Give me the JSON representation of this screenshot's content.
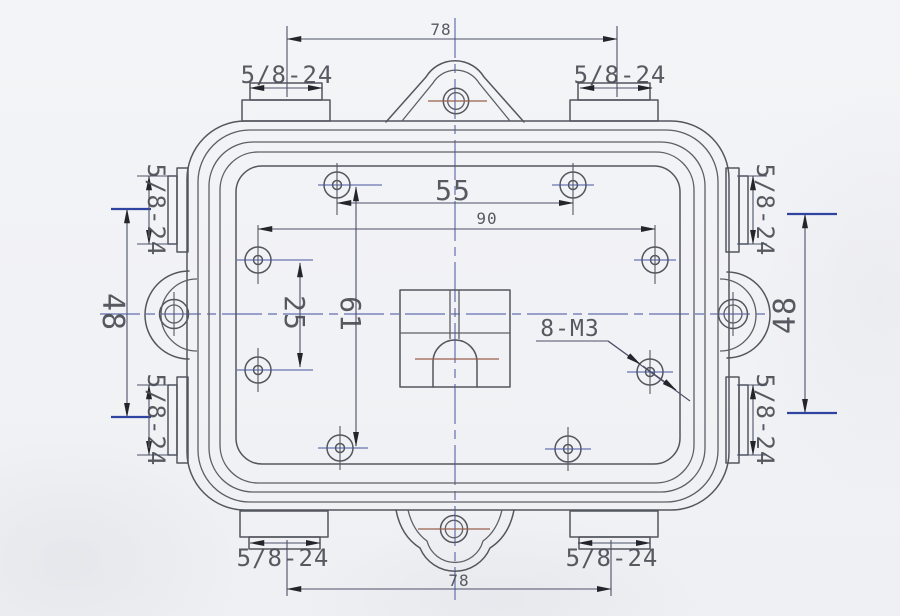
{
  "drawing": {
    "dimensions": {
      "top_width": "78",
      "bottom_width": "78",
      "upper_hole_span": "55",
      "wide_hole_span": "90",
      "left_hole_span": "25",
      "vertical_hole_span": "61",
      "left_port_span": "48",
      "right_port_span": "48"
    },
    "thread_labels": {
      "top_left": "5/8-24",
      "top_right": "5/8-24",
      "left_upper": "5/8-24",
      "left_lower": "5/8-24",
      "right_upper": "5/8-24",
      "right_lower": "5/8-24",
      "bottom_left": "5/8-24",
      "bottom_right": "5/8-24"
    },
    "callouts": {
      "screw_holes": "8-M3"
    },
    "colors": {
      "paper": "#f1f2f5",
      "outline": "#54565e",
      "dimension": "#4c5068",
      "centerline": "#4b58a2",
      "accent_red": "#99604d",
      "arrow": "#23252b",
      "text": "#4b4d55"
    }
  }
}
